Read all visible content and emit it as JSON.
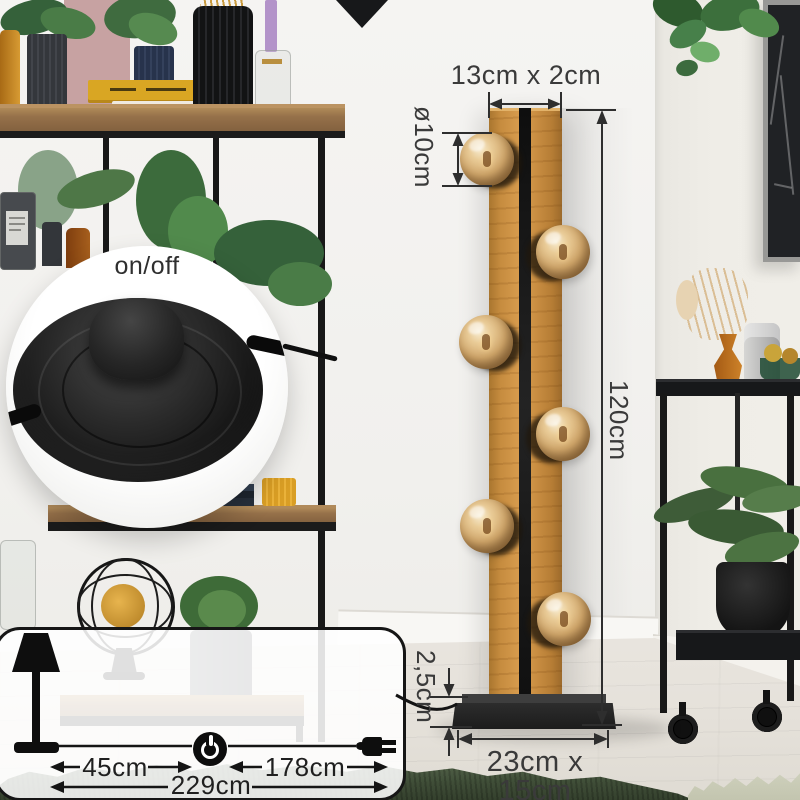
{
  "product_annotations": {
    "profile_dimension": "13cm x 2cm",
    "bulb_diameter": "ø10cm",
    "height": "120cm",
    "base_height": "2,5cm",
    "base_footprint": "23cm x 15cm"
  },
  "switch_inset": {
    "label": "on/off",
    "icon": "foot-switch-photo"
  },
  "cord_diagram": {
    "icons": [
      "table-lamp-icon",
      "power-button-icon",
      "plug-icon"
    ],
    "lamp_to_switch": "45cm",
    "switch_to_plug": "178cm",
    "total_cord": "229cm"
  },
  "colors": {
    "wood": "#c68c3f",
    "lamp_stripe": "#1c1c1c",
    "bulb_glass": "#d2a86c",
    "annotation_text": "#3a3a3a",
    "rug_green": "#3f4d37",
    "accent_yellow": "#dfa42c",
    "wall": "#f3f2f0"
  }
}
